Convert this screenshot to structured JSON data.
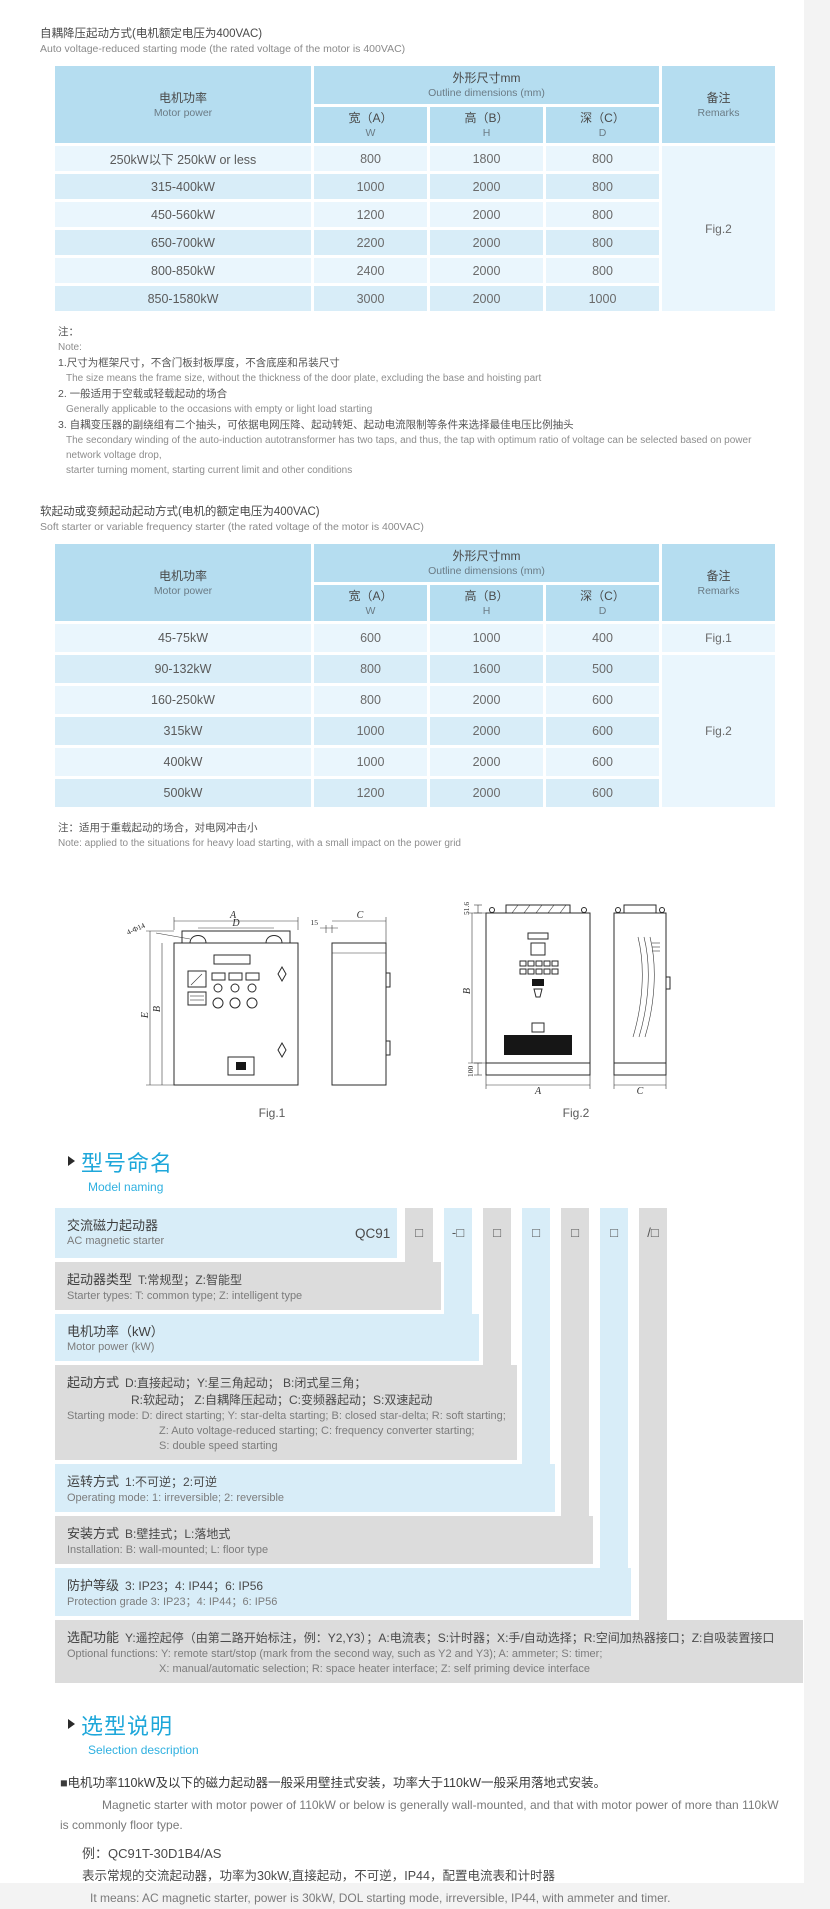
{
  "section1": {
    "title_cn": "自耦降压起动方式(电机额定电压为400VAC)",
    "title_en": "Auto voltage-reduced starting mode (the rated voltage of the motor is 400VAC)",
    "table": {
      "header": {
        "motor_power_cn": "电机功率",
        "motor_power_en": "Motor power",
        "outline_cn": "外形尺寸mm",
        "outline_en": "Outline dimensions (mm)",
        "w_cn": "宽（A）",
        "w_letter": "W",
        "h_cn": "高（B）",
        "h_letter": "H",
        "d_cn": "深（C）",
        "d_letter": "D",
        "remarks_cn": "备注",
        "remarks_en": "Remarks"
      },
      "rows": [
        {
          "power": "250kW以下 250kW or less",
          "w": "800",
          "h": "1800",
          "d": "800"
        },
        {
          "power": "315-400kW",
          "w": "1000",
          "h": "2000",
          "d": "800"
        },
        {
          "power": "450-560kW",
          "w": "1200",
          "h": "2000",
          "d": "800"
        },
        {
          "power": "650-700kW",
          "w": "2200",
          "h": "2000",
          "d": "800"
        },
        {
          "power": "800-850kW",
          "w": "2400",
          "h": "2000",
          "d": "800"
        },
        {
          "power": "850-1580kW",
          "w": "3000",
          "h": "2000",
          "d": "1000"
        }
      ],
      "remark_merged": "Fig.2"
    },
    "notes": {
      "label_cn": "注：",
      "label_en": "Note:",
      "item1_cn": "1.尺寸为框架尺寸，不含门板封板厚度，不含底座和吊装尺寸",
      "item1_en": "The size means the frame size, without the thickness of the door plate, excluding the base and hoisting part",
      "item2_cn": "2. 一般适用于空载或轻载起动的场合",
      "item2_en": "Generally applicable to the occasions with empty or light load starting",
      "item3_cn": "3. 自耦变压器的副绕组有二个抽头，可依据电网压降、起动转矩、起动电流限制等条件来选择最佳电压比例抽头",
      "item3_en": "The secondary winding of the auto-induction autotransformer has two taps, and thus, the tap with optimum ratio of voltage can be selected based on power network voltage drop,",
      "item3_en2": "starter turning moment, starting current limit and other conditions"
    }
  },
  "section2": {
    "title_cn": "软起动或变频起动起动方式(电机的额定电压为400VAC)",
    "title_en": "Soft starter or variable frequency starter (the rated voltage of the motor is 400VAC)",
    "table": {
      "header": {
        "motor_power_cn": "电机功率",
        "motor_power_en": "Motor power",
        "outline_cn": "外形尺寸mm",
        "outline_en": "Outline dimensions (mm)",
        "w_cn": "宽（A）",
        "w_letter": "W",
        "h_cn": "高（B）",
        "h_letter": "H",
        "d_cn": "深（C）",
        "d_letter": "D",
        "remarks_cn": "备注",
        "remarks_en": "Remarks"
      },
      "rows": [
        {
          "power": "45-75kW",
          "w": "600",
          "h": "1000",
          "d": "400"
        },
        {
          "power": "90-132kW",
          "w": "800",
          "h": "1600",
          "d": "500"
        },
        {
          "power": "160-250kW",
          "w": "800",
          "h": "2000",
          "d": "600"
        },
        {
          "power": "315kW",
          "w": "1000",
          "h": "2000",
          "d": "600"
        },
        {
          "power": "400kW",
          "w": "1000",
          "h": "2000",
          "d": "600"
        },
        {
          "power": "500kW",
          "w": "1200",
          "h": "2000",
          "d": "600"
        }
      ],
      "remark_row1": "Fig.1",
      "remark_merged": "Fig.2"
    },
    "note_cn": "注：适用于重载起动的场合，对电网冲击小",
    "note_en": "Note: applied to the situations for heavy load starting, with a small impact on the power grid"
  },
  "figures": {
    "fig1": {
      "caption": "Fig.1",
      "dim_a": "A",
      "dim_d": "D",
      "dim_holes": "4-Φ14",
      "dim_e": "E",
      "dim_b": "B",
      "dim_15": "15",
      "dim_c": "C"
    },
    "fig2": {
      "caption": "Fig.2",
      "dim_top": "51.6",
      "dim_b": "B",
      "dim_base": "100",
      "dim_a": "A",
      "dim_c": "C"
    }
  },
  "naming": {
    "heading_cn": "型号命名",
    "heading_en": "Model naming",
    "prefix": "QC91",
    "boxes": [
      "□",
      "-□",
      "□",
      "□",
      "□",
      "□",
      "/□"
    ],
    "rows": [
      {
        "label": "交流磁力起动器",
        "en": "AC magnetic starter"
      },
      {
        "label": "起动器类型",
        "desc": "T:常规型；Z:智能型",
        "en": "Starter types: T: common type; Z: intelligent type"
      },
      {
        "label": "电机功率（kW）",
        "en": "Motor power (kW)"
      },
      {
        "label": "起动方式",
        "desc": "D:直接起动；Y:星三角起动；  B:闭式星三角；",
        "desc2": "R:软起动；  Z:自耦降压起动；C:变频器起动；S:双速起动",
        "en": "Starting mode: D: direct starting; Y: star-delta starting; B: closed star-delta; R: soft starting;",
        "en2": "Z: Auto voltage-reduced starting; C: frequency converter starting;",
        "en3": "S: double speed starting"
      },
      {
        "label": "运转方式",
        "desc": "1:不可逆；2:可逆",
        "en": "Operating mode: 1: irreversible; 2: reversible"
      },
      {
        "label": "安装方式",
        "desc": "B:壁挂式；L:落地式",
        "en": "Installation: B: wall-mounted; L: floor type"
      },
      {
        "label": "防护等级",
        "desc": "3: IP23；4: IP44；6: IP56",
        "en": "Protection grade  3: IP23；4: IP44；6: IP56"
      },
      {
        "label": "选配功能",
        "desc": "Y:遥控起停（由第二路开始标注，例：Y2,Y3）；A:电流表；S:计时器；X:手/自动选择；R:空间加热器接口；Z:自吸装置接口",
        "en": "Optional functions: Y: remote start/stop (mark from the second way, such as Y2 and Y3); A: ammeter; S: timer;",
        "en2": "X: manual/automatic selection; R: space heater interface; Z: self priming device interface"
      }
    ]
  },
  "selection": {
    "heading_cn": "选型说明",
    "heading_en": "Selection description",
    "para1_cn": "■电机功率110kW及以下的磁力起动器一般采用壁挂式安装，功率大于110kW一般采用落地式安装。",
    "para1_en": "Magnetic starter with motor power of 110kW or below is generally wall-mounted, and that with motor power of more than 110kW is commonly floor type.",
    "example_label": "例：QC91T-30D1B4/AS",
    "example_cn": "表示常规的交流起动器，功率为30kW,直接起动，不可逆，IP44，配置电流表和计时器",
    "example_en": "It means: AC magnetic starter, power is 30kW, DOL starting mode, irreversible, IP44, with ammeter and timer."
  },
  "colors": {
    "accent_blue": "#1ea7da",
    "table_header": "#b5ddf0",
    "row_light": "#eaf6fd",
    "row_mid": "#d8edf8",
    "naming_gray": "#dcdcdc"
  }
}
